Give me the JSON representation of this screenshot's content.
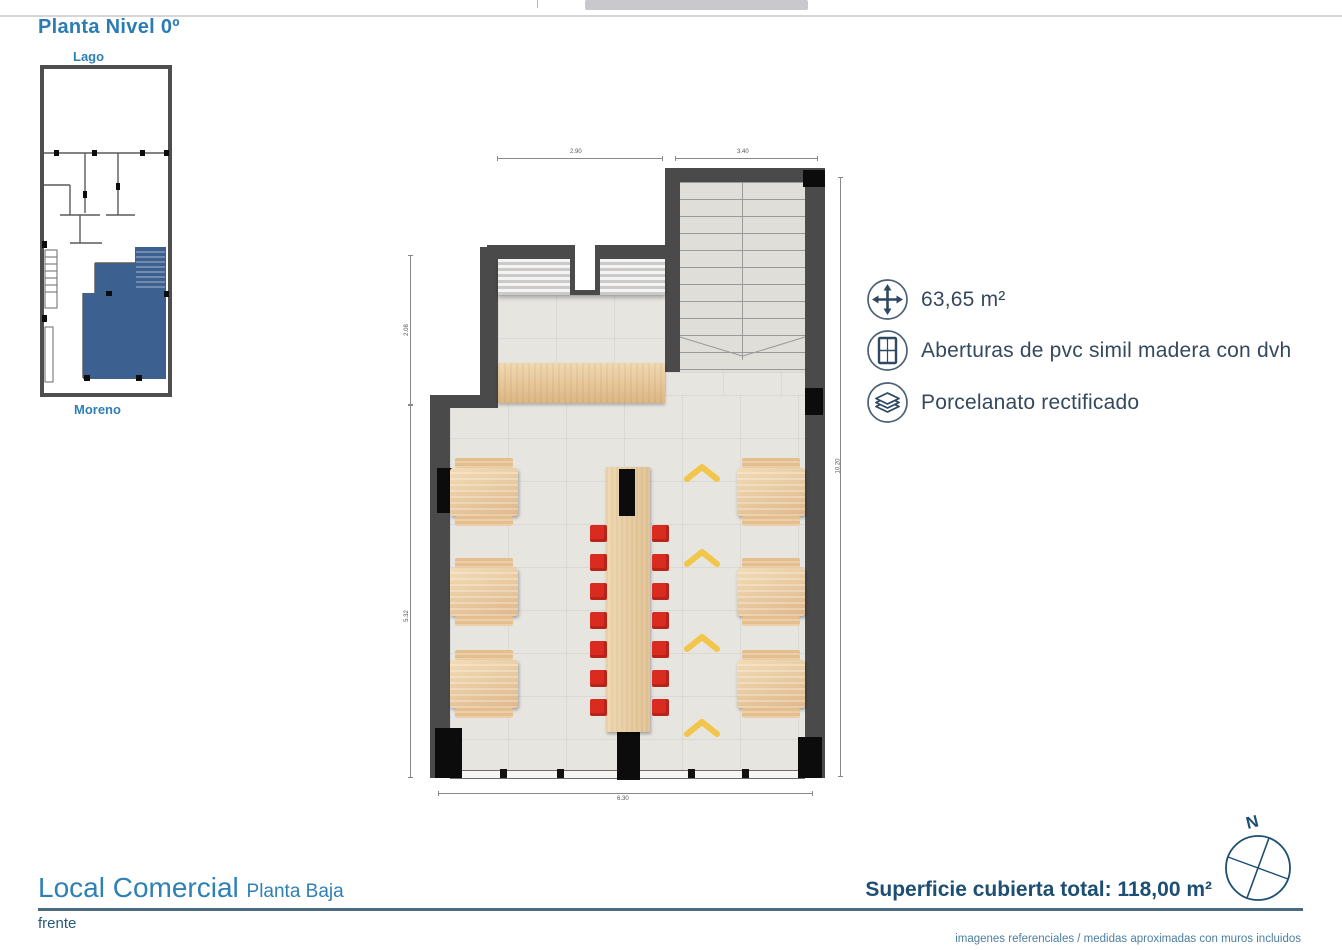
{
  "header": {
    "title": "Planta Nivel 0º"
  },
  "key_plan": {
    "top_label": "Lago",
    "bottom_label": "Moreno",
    "highlight_color": "#3c6191"
  },
  "annotations": {
    "items": [
      {
        "icon": "move-arrows-icon",
        "label": "63,65 m²"
      },
      {
        "icon": "window-icon",
        "label": "Aberturas de pvc simil madera con dvh"
      },
      {
        "icon": "layers-icon",
        "label": "Porcelanato rectificado"
      }
    ]
  },
  "plan": {
    "dimensions": {
      "top_left": "2.90",
      "top_right": "3.40",
      "left_upper": "2.08",
      "left_lower": "5.32",
      "right_side": "10.20",
      "bottom": "6.30"
    },
    "colors": {
      "wall": "#4a4a4a",
      "floor": "#e7e5e0",
      "wood": "#e6c79c",
      "stool_red": "#d92b1f",
      "arrow_yellow": "#f2c64b"
    }
  },
  "footer": {
    "title": "Local Comercial",
    "subtitle": "Planta Baja",
    "front_label": "frente",
    "total_area": "Superficie cubierta total: 118,00 m²",
    "disclaimer": "imagenes referenciales / medidas aproximadas con muros incluidos",
    "compass_label": "N",
    "accent_color": "#2e80b5"
  }
}
